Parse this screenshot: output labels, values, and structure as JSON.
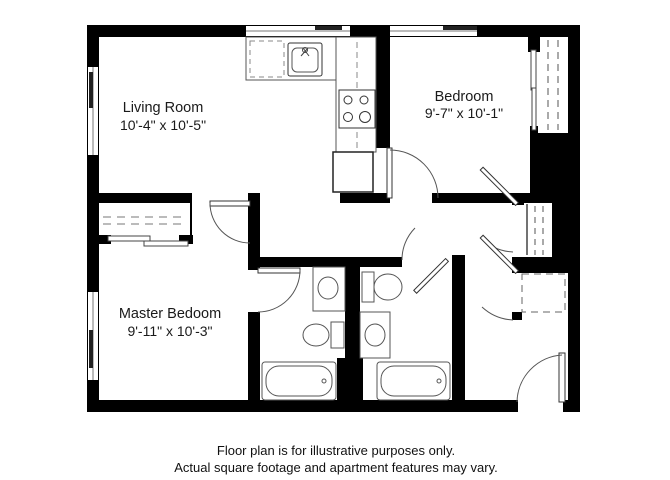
{
  "plan": {
    "rooms": [
      {
        "name": "Living Room",
        "dims": "10'-4\" x 10'-5\""
      },
      {
        "name": "Bedroom",
        "dims": "9'-7\" x 10'-1\""
      },
      {
        "name": "Master Bedoom",
        "dims": "9'-11\" x 10'-3\""
      }
    ],
    "disclaimer": [
      "Floor plan is for illustrative purposes only.",
      "Actual square footage and apartment features may vary."
    ],
    "colors": {
      "wall": "#000000",
      "background": "#ffffff",
      "fixture_line": "#555555"
    },
    "fixtures": [
      "kitchen-sink",
      "dishwasher",
      "stove",
      "refrigerator",
      "toilet",
      "bathtub",
      "vanity-sink",
      "sliding-closet",
      "window",
      "swing-door"
    ]
  }
}
